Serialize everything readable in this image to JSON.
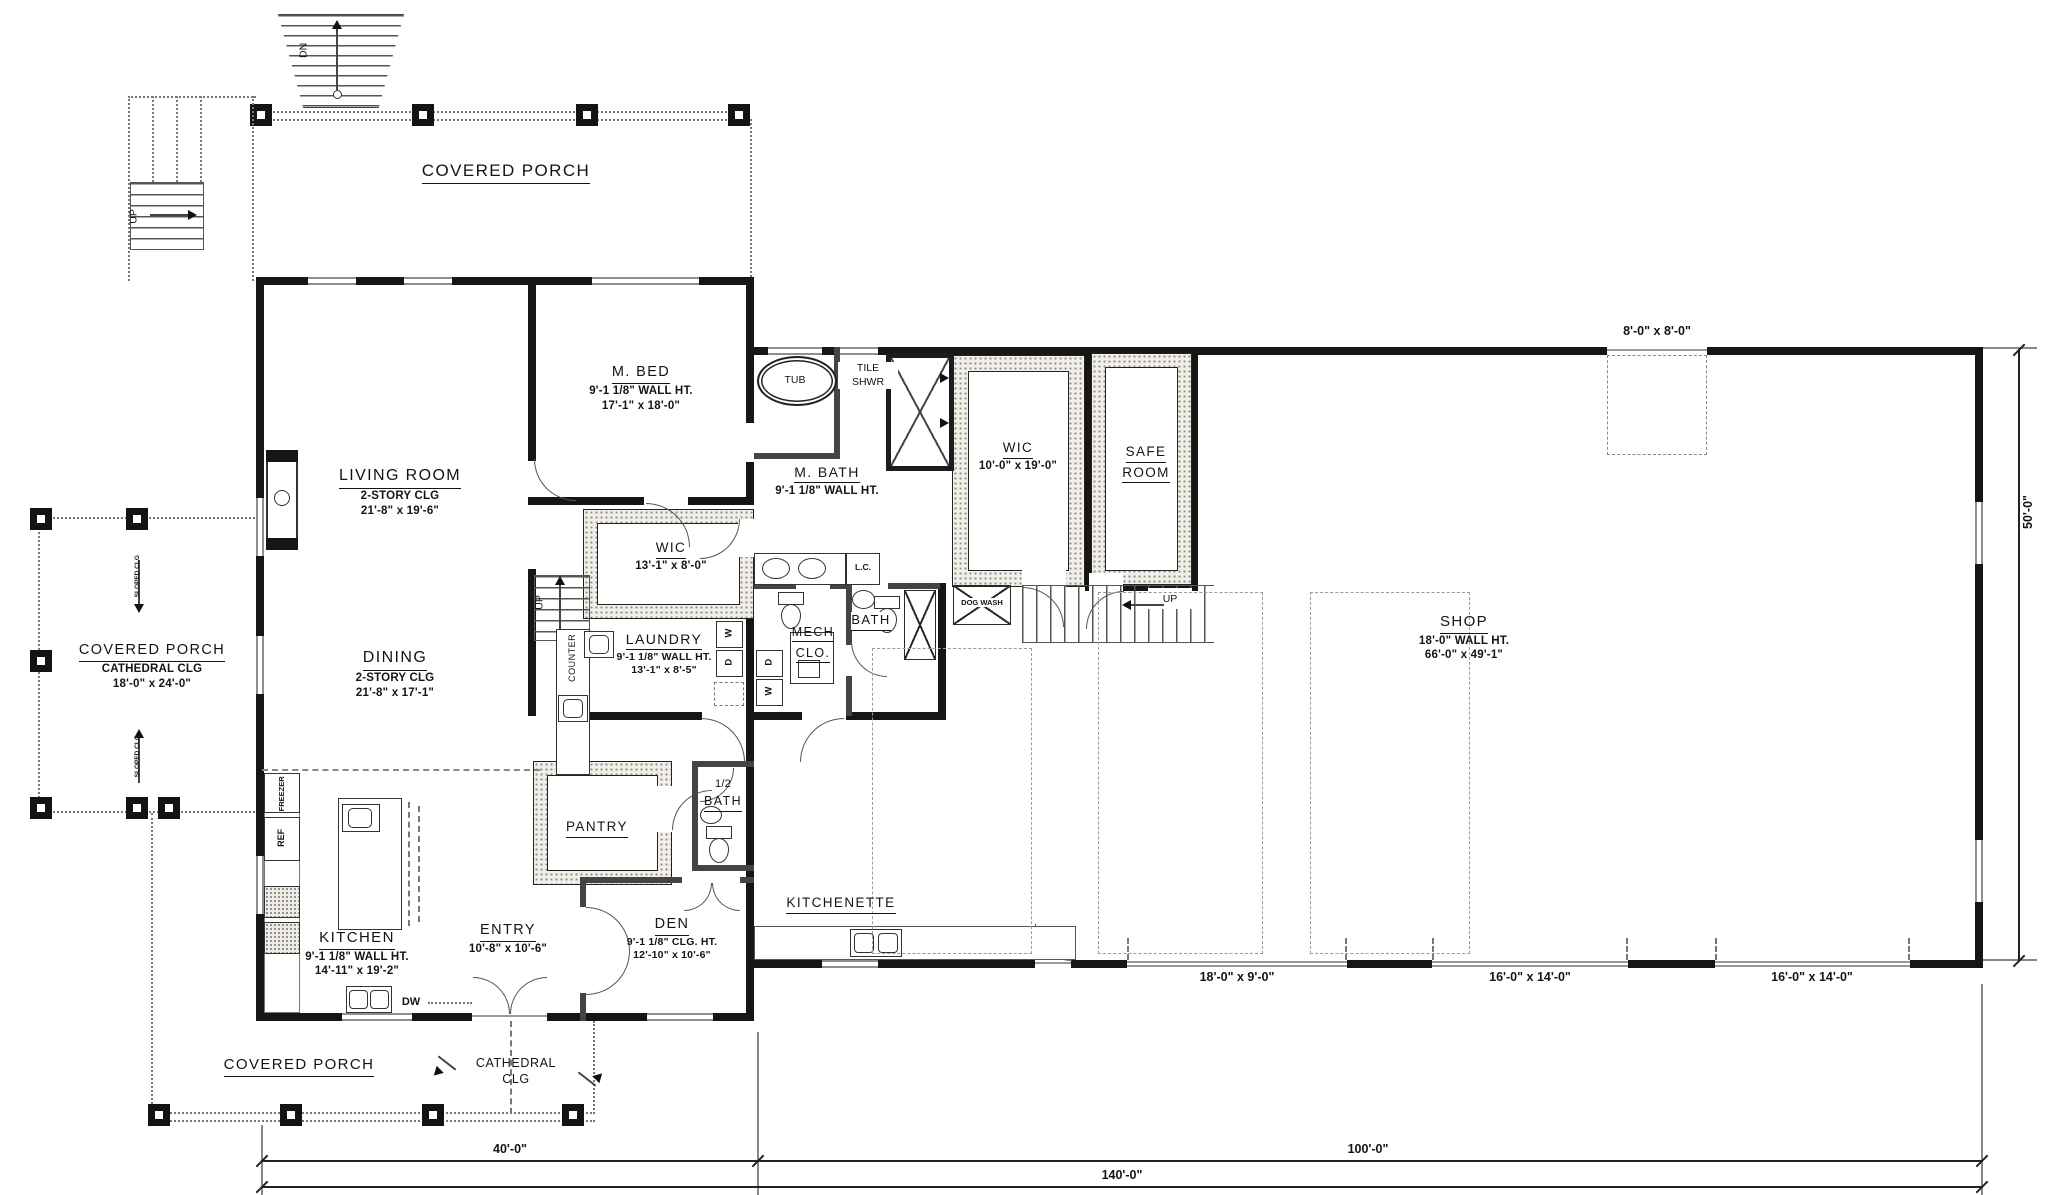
{
  "rooms": {
    "porch_top": {
      "title": "COVERED PORCH"
    },
    "porch_left": {
      "title": "COVERED PORCH",
      "clg": "CATHEDRAL CLG",
      "size": "18'-0\" x 24'-0\""
    },
    "porch_bottom": {
      "title": "COVERED PORCH"
    },
    "living": {
      "title": "LIVING ROOM",
      "clg": "2-STORY CLG",
      "size": "21'-8\" x 19'-6\""
    },
    "dining": {
      "title": "DINING",
      "clg": "2-STORY CLG",
      "size": "21'-8\" x 17'-1\""
    },
    "kitchen": {
      "title": "KITCHEN",
      "wall": "9'-1 1/8\" WALL HT.",
      "size": "14'-11\" x 19'-2\""
    },
    "entry": {
      "title": "ENTRY",
      "size": "10'-8\" x 10'-6\""
    },
    "den": {
      "title": "DEN",
      "clg": "9'-1 1/8\" CLG. HT.",
      "size": "12'-10\" x 10'-6\""
    },
    "pantry": {
      "title": "PANTRY"
    },
    "half_bath": {
      "line1": "1/2",
      "line2": "BATH"
    },
    "mbed": {
      "title": "M. BED",
      "wall": "9'-1 1/8\" WALL HT.",
      "size": "17'-1\" x 18'-0\""
    },
    "mbath": {
      "title": "M. BATH",
      "wall": "9'-1 1/8\" WALL HT."
    },
    "wic_master": {
      "title": "WIC",
      "size": "10'-0\" x 19'-0\""
    },
    "wic_hall": {
      "title": "WIC",
      "size": "13'-1\" x 8'-0\""
    },
    "laundry": {
      "title": "LAUNDRY",
      "wall": "9'-1 1/8\" WALL HT.",
      "size": "13'-1\" x 8'-5\""
    },
    "mech_clo": {
      "line1": "MECH",
      "line2": "CLO."
    },
    "bath": {
      "title": "BATH"
    },
    "safe_room": {
      "line1": "SAFE",
      "line2": "ROOM"
    },
    "shop": {
      "title": "SHOP",
      "wall": "18'-0\" WALL HT.",
      "size": "66'-0\" x 49'-1\""
    },
    "kitchenette": {
      "title": "KITCHENETTE"
    }
  },
  "fixtures": {
    "tub": "TUB",
    "tile_shwr_1": "TILE",
    "tile_shwr_2": "SHWR",
    "lc": "L.C.",
    "dog_wash": "DOG WASH",
    "counter": "COUNTER",
    "freezer": "FREEZER",
    "ref": "REF",
    "dw": "DW",
    "washer": "W",
    "dryer": "D",
    "up": "UP",
    "dn": "DN",
    "sloped_clg": "SLOPED CLG",
    "cathedral_1": "CATHEDRAL",
    "cathedral_2": "CLG"
  },
  "dimensions": {
    "house_width": "40'-0\"",
    "shop_width": "100'-0\"",
    "total_width": "140'-0\"",
    "shop_depth": "50'-0\"",
    "shop_opening": "8'-0\" x 8'-0\"",
    "garage_door_1": "18'-0\" x 9'-0\"",
    "garage_door_2": "16'-0\" x 14'-0\"",
    "garage_door_3": "16'-0\" x 14'-0\""
  }
}
